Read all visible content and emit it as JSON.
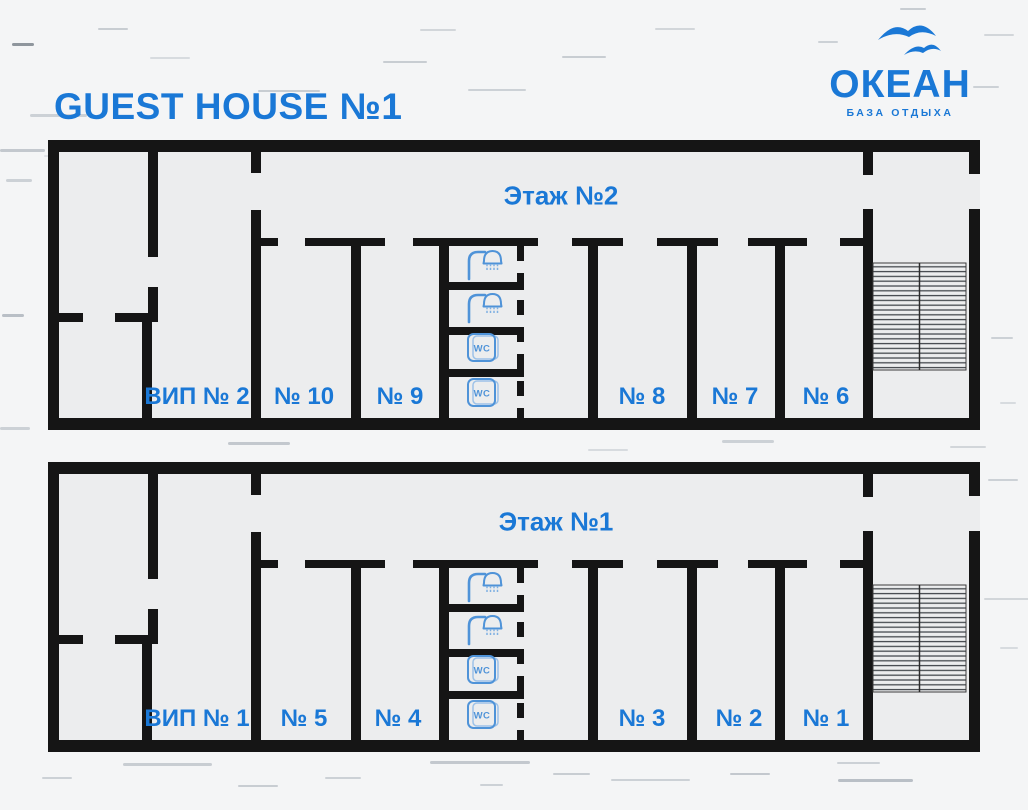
{
  "header": {
    "title": "GUEST HOUSE №1"
  },
  "brand": {
    "logo_text": "ОКЕАН",
    "tagline": "БАЗА ОТДЫХА",
    "birds_icon": "seagulls-icon"
  },
  "colors": {
    "accent_blue": "#1a78d6",
    "icon_blue": "#4f93d8",
    "icon_blue_light": "#9dc2e8",
    "wall_black": "#151515",
    "background": "#f4f5f6",
    "floor_fill": "#ecedee"
  },
  "floors": [
    {
      "label": "Этаж №2",
      "rooms": [
        {
          "label": "ВИП № 2"
        },
        {
          "label": "№ 10"
        },
        {
          "label": "№ 9"
        },
        {
          "label": "№ 8"
        },
        {
          "label": "№ 7"
        },
        {
          "label": "№ 6"
        }
      ],
      "sanitary": {
        "showers": 2,
        "wcs": 2,
        "wc_label": "WC"
      },
      "features": [
        "staircase"
      ]
    },
    {
      "label": "Этаж №1",
      "rooms": [
        {
          "label": "ВИП № 1"
        },
        {
          "label": "№ 5"
        },
        {
          "label": "№ 4"
        },
        {
          "label": "№ 3"
        },
        {
          "label": "№ 2"
        },
        {
          "label": "№ 1"
        }
      ],
      "sanitary": {
        "showers": 2,
        "wcs": 2,
        "wc_label": "WC"
      },
      "features": [
        "staircase"
      ]
    }
  ],
  "decor": {
    "dashes": [
      {
        "x": 98,
        "y": 28,
        "w": 30,
        "h": 2,
        "c": "#c8cdd2"
      },
      {
        "x": 12,
        "y": 43,
        "w": 22,
        "h": 3,
        "c": "#8f969d"
      },
      {
        "x": 150,
        "y": 57,
        "w": 40,
        "h": 2,
        "c": "#d7dbdf"
      },
      {
        "x": 258,
        "y": 90,
        "w": 62,
        "h": 2,
        "c": "#c8cdd2"
      },
      {
        "x": 30,
        "y": 114,
        "w": 57,
        "h": 3,
        "c": "#ccd1d6"
      },
      {
        "x": 0,
        "y": 149,
        "w": 45,
        "h": 3,
        "c": "#c3c8ce"
      },
      {
        "x": 44,
        "y": 155,
        "w": 90,
        "h": 2,
        "c": "#dfe2e6"
      },
      {
        "x": 383,
        "y": 61,
        "w": 44,
        "h": 2,
        "c": "#c8cdd2"
      },
      {
        "x": 420,
        "y": 29,
        "w": 36,
        "h": 2,
        "c": "#d2d6da"
      },
      {
        "x": 468,
        "y": 89,
        "w": 58,
        "h": 2,
        "c": "#ccd1d6"
      },
      {
        "x": 562,
        "y": 56,
        "w": 44,
        "h": 2,
        "c": "#c8cdd2"
      },
      {
        "x": 655,
        "y": 28,
        "w": 40,
        "h": 2,
        "c": "#d2d6da"
      },
      {
        "x": 588,
        "y": 171,
        "w": 40,
        "h": 2,
        "c": "#dde0e3"
      },
      {
        "x": 806,
        "y": 145,
        "w": 28,
        "h": 2,
        "c": "#d7dbdf"
      },
      {
        "x": 818,
        "y": 41,
        "w": 20,
        "h": 2,
        "c": "#ccd1d6"
      },
      {
        "x": 900,
        "y": 8,
        "w": 26,
        "h": 2,
        "c": "#c8cdd2"
      },
      {
        "x": 973,
        "y": 86,
        "w": 26,
        "h": 2,
        "c": "#ccd1d6"
      },
      {
        "x": 984,
        "y": 34,
        "w": 30,
        "h": 2,
        "c": "#d2d6da"
      },
      {
        "x": 6,
        "y": 179,
        "w": 26,
        "h": 3,
        "c": "#ccd1d6"
      },
      {
        "x": 2,
        "y": 314,
        "w": 22,
        "h": 3,
        "c": "#b9bfc6"
      },
      {
        "x": 0,
        "y": 427,
        "w": 30,
        "h": 3,
        "c": "#ccd1d6"
      },
      {
        "x": 228,
        "y": 442,
        "w": 62,
        "h": 3,
        "c": "#c3c8ce"
      },
      {
        "x": 588,
        "y": 449,
        "w": 40,
        "h": 2,
        "c": "#d7dbdf"
      },
      {
        "x": 722,
        "y": 440,
        "w": 52,
        "h": 3,
        "c": "#ccd1d6"
      },
      {
        "x": 950,
        "y": 446,
        "w": 36,
        "h": 2,
        "c": "#d2d6da"
      },
      {
        "x": 991,
        "y": 337,
        "w": 22,
        "h": 2,
        "c": "#ccd1d6"
      },
      {
        "x": 1000,
        "y": 402,
        "w": 16,
        "h": 2,
        "c": "#d7dbdf"
      },
      {
        "x": 988,
        "y": 479,
        "w": 30,
        "h": 2,
        "c": "#ccd1d6"
      },
      {
        "x": 984,
        "y": 598,
        "w": 58,
        "h": 2,
        "c": "#d2d6da"
      },
      {
        "x": 1000,
        "y": 647,
        "w": 18,
        "h": 2,
        "c": "#d7dbdf"
      },
      {
        "x": 123,
        "y": 763,
        "w": 89,
        "h": 3,
        "c": "#c8cdd2"
      },
      {
        "x": 42,
        "y": 777,
        "w": 30,
        "h": 2,
        "c": "#ccd1d6"
      },
      {
        "x": 238,
        "y": 785,
        "w": 40,
        "h": 2,
        "c": "#c8cdd2"
      },
      {
        "x": 325,
        "y": 777,
        "w": 36,
        "h": 2,
        "c": "#ccd1d6"
      },
      {
        "x": 430,
        "y": 761,
        "w": 100,
        "h": 3,
        "c": "#c3c8ce"
      },
      {
        "x": 480,
        "y": 784,
        "w": 23,
        "h": 2,
        "c": "#ccd1d6"
      },
      {
        "x": 553,
        "y": 773,
        "w": 37,
        "h": 2,
        "c": "#c8cdd2"
      },
      {
        "x": 611,
        "y": 779,
        "w": 79,
        "h": 2,
        "c": "#ccd1d6"
      },
      {
        "x": 730,
        "y": 773,
        "w": 40,
        "h": 2,
        "c": "#c3c8ce"
      },
      {
        "x": 837,
        "y": 762,
        "w": 43,
        "h": 2,
        "c": "#ccd1d6"
      },
      {
        "x": 838,
        "y": 779,
        "w": 75,
        "h": 3,
        "c": "#b9bfc6"
      }
    ]
  }
}
